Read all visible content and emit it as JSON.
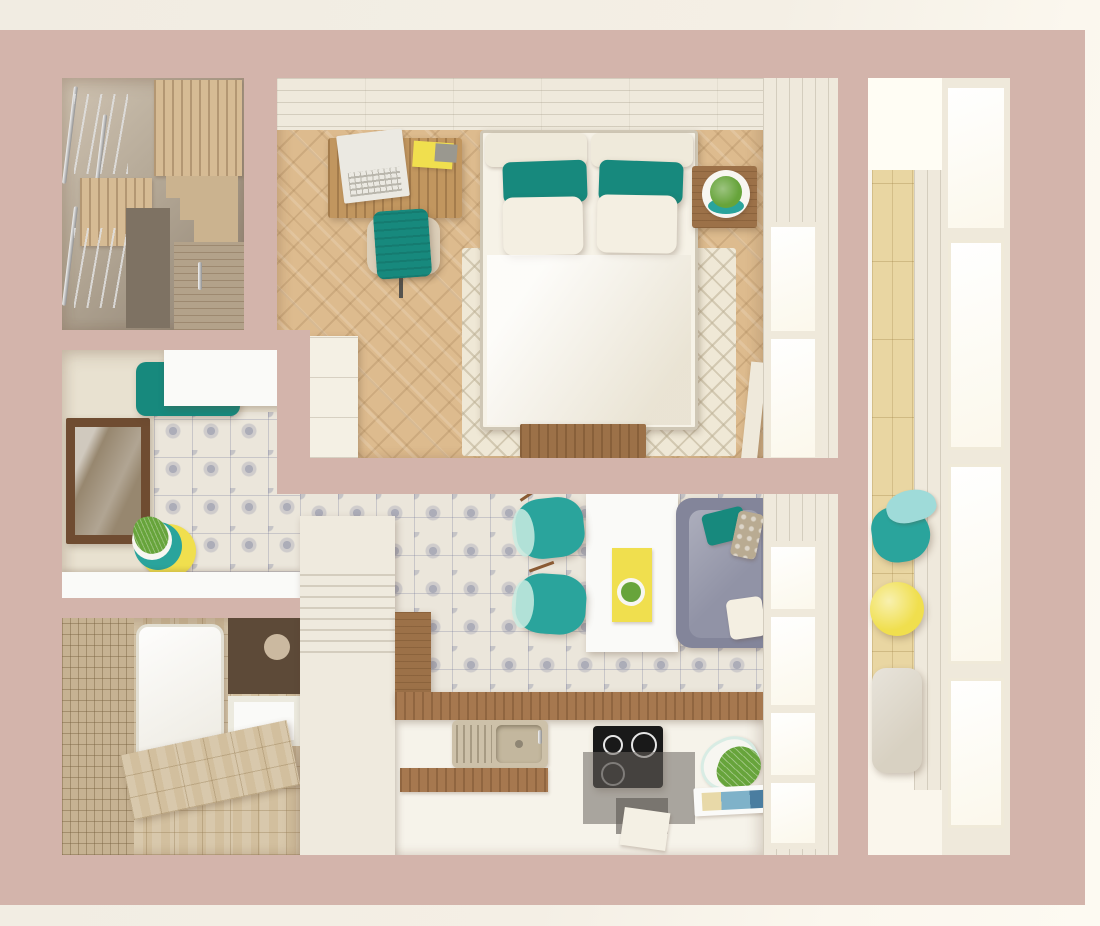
{
  "scene": {
    "description": "Top-down 3D interior render of a studio apartment floor plan",
    "render_style": "photorealistic architectural visualization, no text labels",
    "palette": {
      "outer_bg": "#f2ede3",
      "outer_bg_light": "#fcf8ef",
      "wall": "#d3b4ab",
      "closet_light": "#cfc3b2",
      "closet_dark": "#8e8171",
      "closet_floor_dark": "#7e7263",
      "wood_shelf": "#d6bb94",
      "wood_step": "#cbb38f",
      "wood_door": "#b3a28a",
      "chrome": "#d6d6d6",
      "whitewash_wall": "#efe9dc",
      "bedroom_floor": "#ddbb8e",
      "cream_cabinet": "#f4f0e4",
      "rug_cream": "#efe8d6",
      "bed_white": "#f6f2e7",
      "headboard": "#efeadb",
      "pillow_white": "#f4efe2",
      "teal": "#17897d",
      "teal_bright": "#2aa49c",
      "mint": "#c9ece2",
      "aqua_light": "#9fdbd9",
      "yellow": "#f0df4e",
      "desk_wood": "#c1965f",
      "dark_wood": "#9c7148",
      "counter_wood": "#a6784f",
      "laptop_white": "#ebe9e2",
      "notebook_gray": "#9a988f",
      "chair_base": "#dccfb9",
      "hallway_beige": "#e8e1d0",
      "tile_base": "#ebe6db",
      "tile_motif": "#7d82a8",
      "mirror_brown": "#6f4c31",
      "mirror_inner": "#97876f",
      "white_furniture": "#fafaf8",
      "pot_white": "#f7f6f1",
      "plant_green": "#67a43b",
      "mosaic_beige": "#c6b292",
      "bath_tile": "#d2bf9e",
      "tub_white": "#f5f3ec",
      "bath_cabinet": "#5d4a38",
      "kitchen_floor": "#f6f3ea",
      "cabinet_cream": "#efeade",
      "sink_beige": "#cdc1a9",
      "sink_bowl": "#c3b79e",
      "cooktop_black": "#191919",
      "glass_gray": "rgba(106,100,95,0.55)",
      "sofa_gray": "#83859a",
      "sofa_seat": "#9193a6",
      "pillow_taupe": "#b9ab92",
      "balcony_wood": "#e9d6a2",
      "window_frame": "#efe9db",
      "window_light": "#fffdf4",
      "pouf_gray": "#d8d1c2"
    },
    "rooms": [
      {
        "id": "walk-in-closet",
        "position": "top-left",
        "features": [
          "chrome clothes rails with hangers",
          "wood shelf boxes",
          "stepped shelving",
          "wardrobe door with handle"
        ]
      },
      {
        "id": "bedroom-workspace",
        "position": "top-center",
        "features": [
          "double bed, white duvet",
          "two teal pillows",
          "two white pillows",
          "cream diamond-pattern rug",
          "wood desk with laptop",
          "yellow notepad",
          "teal desk chair",
          "nightstand with plant",
          "dark wood bed-end bench",
          "white wardrobe",
          "herringbone oak floor",
          "window with open sash"
        ]
      },
      {
        "id": "hallway",
        "position": "middle-left",
        "features": [
          "brown framed wall mirror",
          "white floating cabinet over teal bench",
          "stacked yellow and teal plates with wheatgrass",
          "patterned azulejo tile floor",
          "white console"
        ]
      },
      {
        "id": "bathroom",
        "position": "bottom-left",
        "features": [
          "white bathtub",
          "beige mosaic wall",
          "tiled vanity bench with chrome faucet",
          "dark wall cabinet"
        ]
      },
      {
        "id": "kitchen-living",
        "position": "bottom-center",
        "features": [
          "white dining table",
          "yellow serving tray with potted plant",
          "two teal bar stools",
          "gray sofa with teal, taupe and white pillows",
          "tall white cabinet column",
          "wood worktop",
          "double sink",
          "black induction cooktop",
          "smoked-glass hood panels",
          "tilted white planter with fern",
          "magazine",
          "azulejo tile floor",
          "window"
        ]
      },
      {
        "id": "balcony",
        "position": "right",
        "features": [
          "floor-to-ceiling white windows",
          "light wood plank wall",
          "teal lounge chair",
          "round yellow side table",
          "beige fabric pouf"
        ]
      }
    ]
  }
}
